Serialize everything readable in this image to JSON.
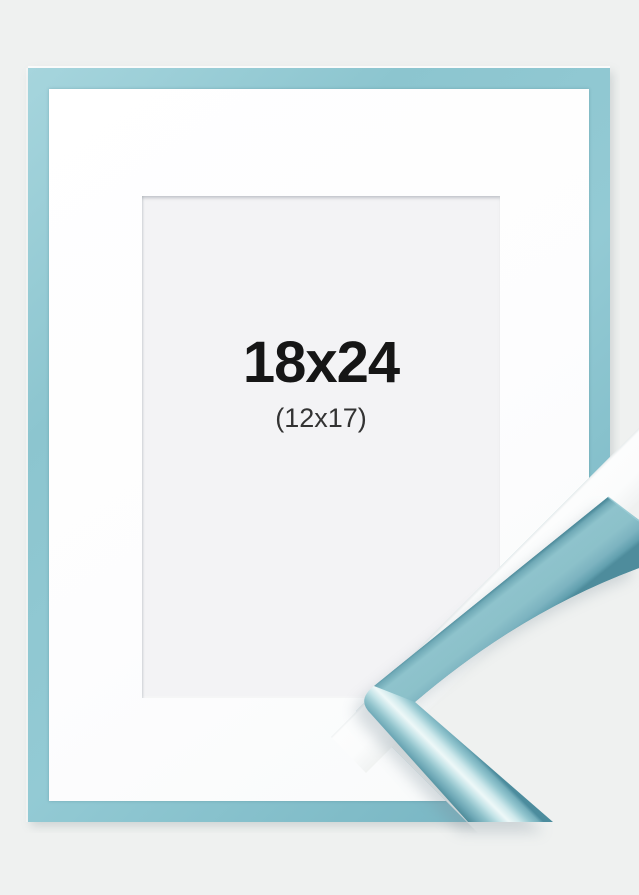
{
  "product": {
    "size_label": "18x24",
    "inner_size_label": "(12x17)"
  },
  "colors": {
    "background": "#eff1f0",
    "frame_blue": "#8cc5cf",
    "frame_blue_dark": "#4c8c9d",
    "frame_gloss_highlight": "#eef8f8",
    "mat_white": "#fdfdfe",
    "opening_gray": "#f3f3f5",
    "label_primary": "#161616",
    "label_secondary": "#333333"
  }
}
